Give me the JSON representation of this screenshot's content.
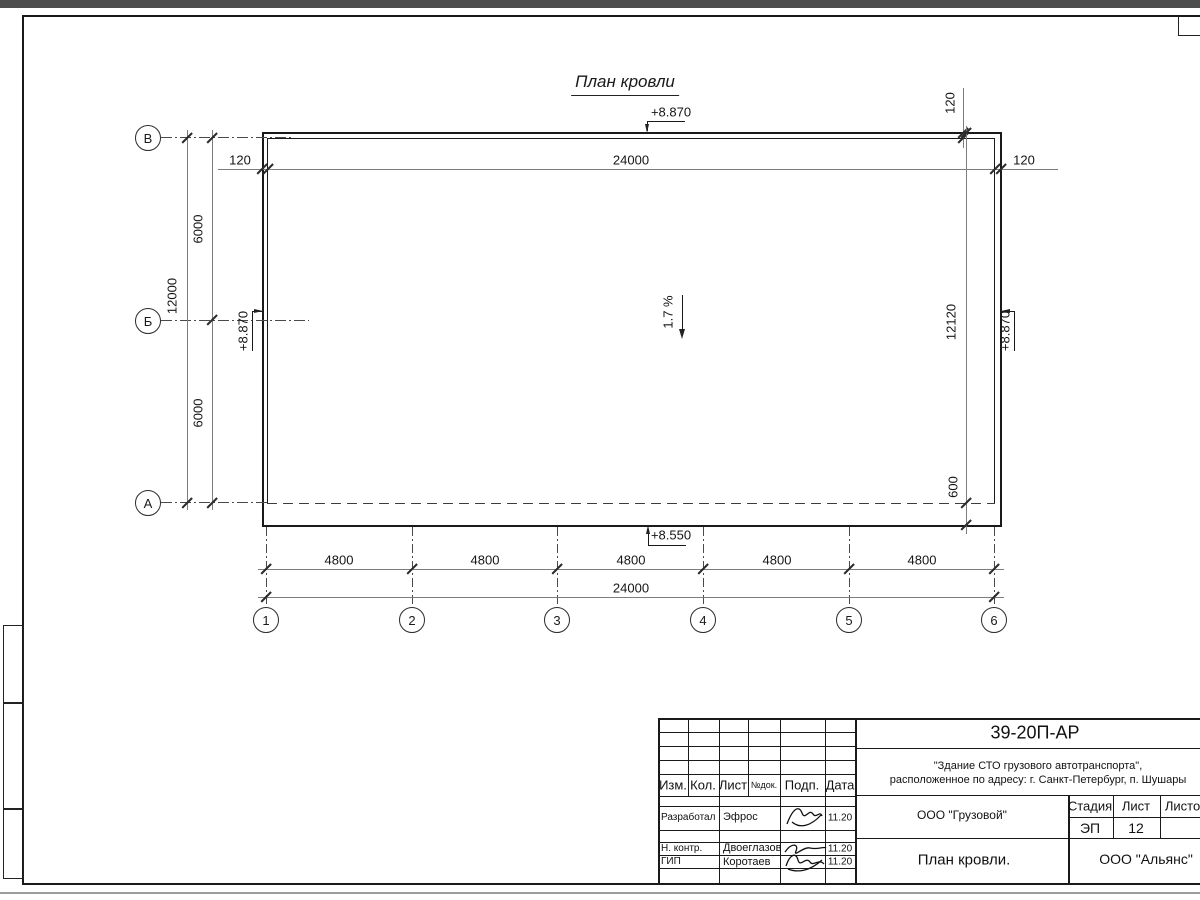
{
  "drawing": {
    "title": "План кровли",
    "slope_label": "1.7 %",
    "elevations": {
      "top": "+8.870",
      "left": "+8.870",
      "right": "+8.870",
      "bottom": "+8.550"
    },
    "dimensions": {
      "parapet_left": "120",
      "parapet_top": "120",
      "parapet_right": "120",
      "top_total": "24000",
      "left_total": "12000",
      "left_upper": "6000",
      "left_lower": "6000",
      "right_total": "12120",
      "right_overhang": "600",
      "bottom_bays": [
        "4800",
        "4800",
        "4800",
        "4800",
        "4800"
      ],
      "bottom_total": "24000"
    },
    "axes_vertical": [
      "В",
      "Б",
      "А"
    ],
    "axes_horizontal": [
      "1",
      "2",
      "3",
      "4",
      "5",
      "6"
    ]
  },
  "title_block": {
    "doc_number": "39-20П-АР",
    "project_line1": "\"Здание СТО грузового автотранспорта\",",
    "project_line2": "расположенное по адресу: г. Санкт-Петербург, п. Шушары",
    "columns": {
      "izm": "Изм.",
      "kol": "Кол.",
      "list": "Лист",
      "ndok": "№док.",
      "podp": "Подп.",
      "data": "Дата"
    },
    "rows": [
      {
        "role": "Разработал",
        "name": "Эфрос",
        "date": "11.20"
      },
      {
        "role": "Н. контр.",
        "name": "Двоеглазов",
        "date": "11.20"
      },
      {
        "role": "ГИП",
        "name": "Коротаев",
        "date": "11.20"
      }
    ],
    "client": "ООО \"Грузовой\"",
    "stage_label": "Стадия",
    "stage": "ЭП",
    "sheet_label": "Лист",
    "sheet": "12",
    "sheets_label": "Листов",
    "sheet_title": "План кровли.",
    "company": "ООО \"Альянс\""
  }
}
